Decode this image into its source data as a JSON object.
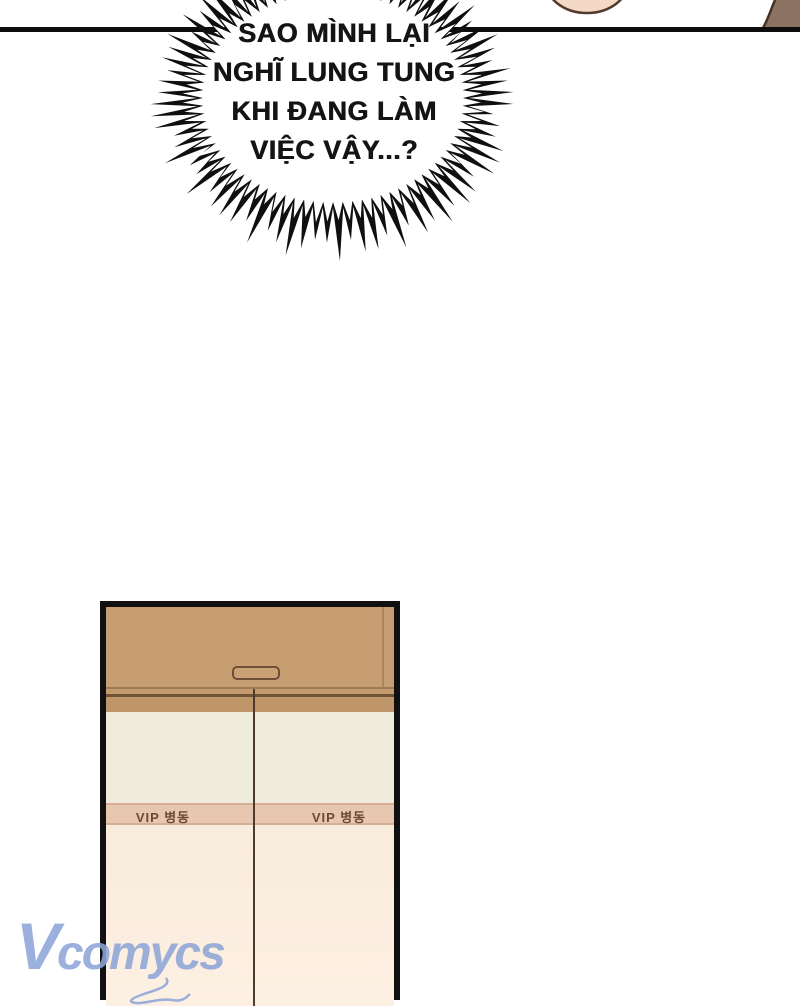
{
  "bubble": {
    "lines": [
      "SAO MÌNH LẠI",
      "NGHĨ LUNG TUNG",
      "KHI ĐANG LÀM",
      "VIỆC VẬY...?"
    ]
  },
  "door": {
    "vip_label": "VIP 병동"
  },
  "watermark": {
    "initial": "V",
    "rest": "comycs"
  },
  "colors": {
    "panel_line": "#0d0d0d",
    "bubble_text": "#141414",
    "door_header_tan": "#c79d72",
    "door_top_band": "#bf956a",
    "door_cream": "#f0ecdc",
    "door_vip_band": "#e8c7b0",
    "door_lower_pink": "#f8ecdc",
    "vip_label_brown": "#6b4a33",
    "skin": "#f3d9c6",
    "hair": "#8b7261",
    "watermark_blue": "#8ea6d8"
  }
}
